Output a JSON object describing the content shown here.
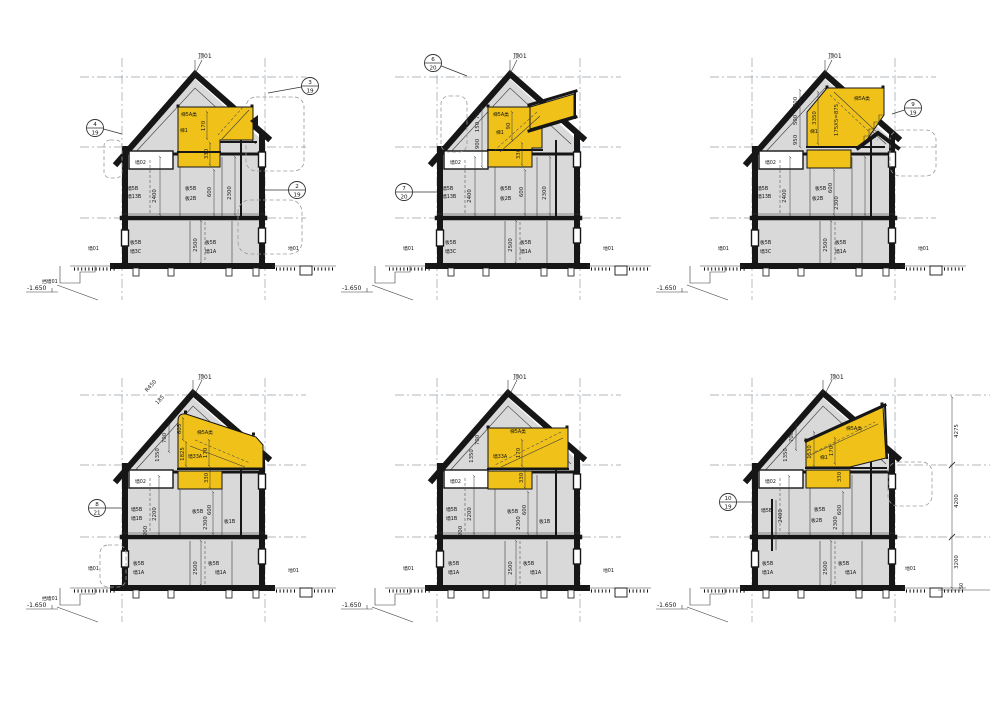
{
  "colors": {
    "highlight": "#f0c219",
    "wall_fill": "#d9d9d9",
    "line": "#161616"
  },
  "right_dims": {
    "d1": "4275",
    "d2": "4200",
    "d3": "3200",
    "d4": "50"
  },
  "sections": [
    {
      "bubble_left": {
        "n": "4",
        "d": "19"
      },
      "bubble_top": {
        "n": "3",
        "d": "19"
      },
      "bubble_right": {
        "n": "2",
        "d": "19"
      },
      "roof": "顶01",
      "stair": "梯5A类",
      "stair2": "梯1",
      "dim_a": "170",
      "dim_b": "330",
      "dim_c": "600",
      "wall02": "墙02",
      "wall_l1": "墙5B",
      "wall_l2": "墙13B",
      "dim_attic": "2400",
      "slab_m1": "板5B",
      "slab_m2": "板2B",
      "dim_mid": "2300",
      "slab_b1": "板5B",
      "wall_b1": "墙3C",
      "dim_low": "2500",
      "slab_b2": "板5B",
      "wall_b2": "墙1A",
      "wall01": "墙01",
      "ground": "地01",
      "retain": "挡墙01",
      "elev": "-1.650"
    },
    {
      "bubble_top": {
        "n": "6",
        "d": "20"
      },
      "bubble_left": {
        "n": "7",
        "d": "20"
      },
      "roof": "顶01",
      "stair": "梯5A类",
      "stair2": "梯1",
      "dim_a": "90",
      "dim_b": "330",
      "dim_c": "600",
      "chain1": "700",
      "chain2": "150",
      "chain3": "900",
      "wall02": "墙02",
      "wall_l1": "墙5B",
      "wall_l2": "墙13B",
      "dim_attic": "2400",
      "slab_m1": "板5B",
      "slab_m2": "板2B",
      "dim_mid": "2300",
      "slab_b1": "板5B",
      "wall_b1": "墙3C",
      "dim_low": "2500",
      "slab_b2": "板5B",
      "wall_b2": "墙1A",
      "wall01": "墙01",
      "ground": "地01",
      "elev": "-1.650"
    },
    {
      "bubble_right": {
        "n": "9",
        "d": "19"
      },
      "roof": "顶01",
      "stair": "梯5A类",
      "stair2": "梯1",
      "dim_a": "3350",
      "dim_b": "175X5=875",
      "dim_c": "600",
      "chain1": "700",
      "chain2": "500",
      "chain3": "950",
      "wall02": "墙02",
      "wall_l1": "墙5B",
      "wall_l2": "墙13B",
      "dim_attic": "2400",
      "slab_m1": "板5B",
      "slab_m2": "板2B",
      "dim_mid": "2300",
      "slab_b1": "板5B",
      "wall_b1": "墙3C",
      "dim_low": "2500",
      "slab_b2": "板5B",
      "wall_b2": "墙1A",
      "wall01": "墙01",
      "ground": "地01",
      "elev": "-1.650"
    },
    {
      "bubble_left": {
        "n": "8",
        "d": "21"
      },
      "roof": "顶01",
      "stair": "梯5A类",
      "wall33": "墙33A",
      "dim_a": "170",
      "dim_b": "330",
      "dim_c": "600",
      "dim_d": "605",
      "dim_e": "1825",
      "chain1": "700",
      "chain2": "1350",
      "radius": "R450",
      "arc": "185",
      "wall02": "墙02",
      "wall_l1": "墙5B",
      "wall_l2": "墙1B",
      "dim_attic": "2200",
      "dim_f": "200",
      "slab_m1": "板5B",
      "slab_m2": "板1B",
      "dim_mid": "2300",
      "slab_b1": "板5B",
      "wall_b1": "墙1A",
      "dim_low": "2500",
      "slab_b2": "板5B",
      "wall_b2": "墙1A",
      "wall01": "墙01",
      "ground": "地01",
      "retain": "挡墙01",
      "elev": "-1.650"
    },
    {
      "roof": "顶01",
      "stair": "梯5A类",
      "wall33": "墙33A",
      "dim_a": "170",
      "dim_b": "330",
      "dim_c": "600",
      "chain1": "700",
      "chain2": "1350",
      "wall02": "墙02",
      "wall_l1": "墙5B",
      "wall_l2": "墙1B",
      "dim_attic": "2200",
      "dim_f": "200",
      "slab_m1": "板5B",
      "slab_m2": "板1B",
      "dim_mid": "2300",
      "slab_b1": "板5B",
      "wall_b1": "墙1A",
      "dim_low": "2500",
      "slab_b2": "板5B",
      "wall_b2": "墙1A",
      "wall01": "墙01",
      "ground": "地01",
      "elev": "-1.650"
    },
    {
      "bubble_left": {
        "n": "10",
        "d": "19"
      },
      "roof": "顶01",
      "stair": "梯5A类",
      "stair2": "梯1",
      "dim_a": "170",
      "dim_b": "330",
      "dim_c": "600",
      "dim_d": "1530",
      "chain1": "700",
      "chain2": "1350",
      "wall02": "墙02",
      "wall_l1": "墙5B",
      "dim_attic": "2400",
      "slab_m1": "板5B",
      "slab_m2": "板2B",
      "dim_mid": "2300",
      "slab_b1": "板5B",
      "wall_b1": "墙1A",
      "dim_low": "2500",
      "slab_b2": "板5B",
      "wall_b2": "墙1A",
      "ground": "地01",
      "elev": "-1.650"
    }
  ]
}
